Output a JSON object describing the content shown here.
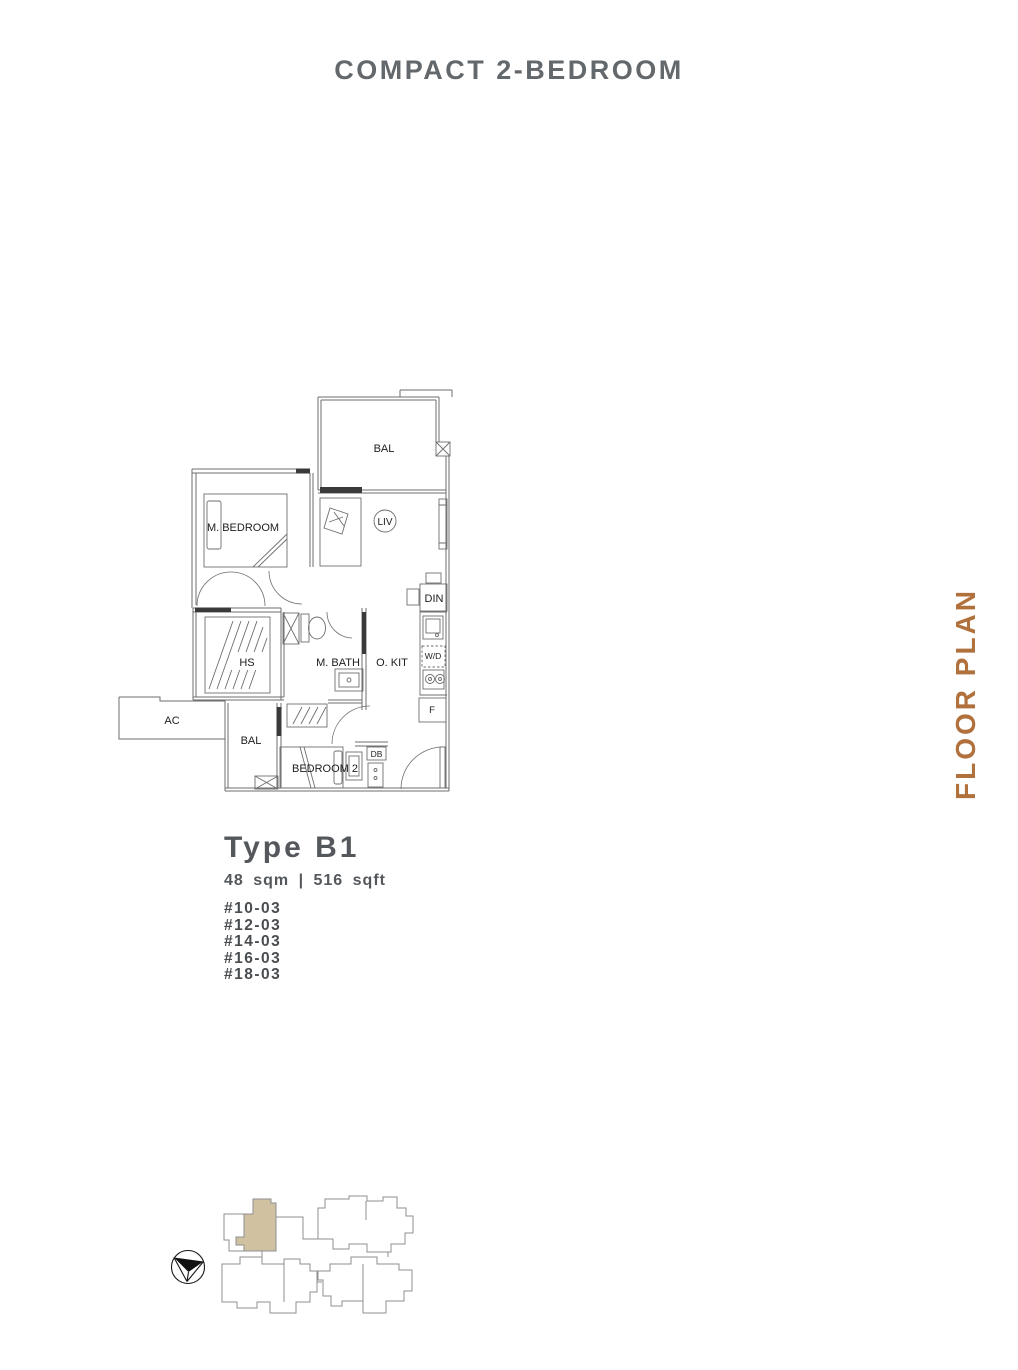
{
  "page": {
    "title": "COMPACT 2-BEDROOM"
  },
  "side_label": "FLOOR PLAN",
  "unit": {
    "type_label": "Type B1",
    "area": "48 sqm | 516 sqft",
    "units": [
      "#10-03",
      "#12-03",
      "#14-03",
      "#16-03",
      "#18-03"
    ]
  },
  "plan": {
    "labels": {
      "bal_top": "BAL",
      "m_bedroom": "M. BEDROOM",
      "liv": "LIV",
      "din": "DIN",
      "wd": "W/D",
      "fridge": "F",
      "hs": "HS",
      "m_bath": "M. BATH",
      "o_kit": "O. KIT",
      "ac": "AC",
      "bal_bottom": "BAL",
      "bedroom2": "BEDROOM 2",
      "db": "DB"
    }
  },
  "colors": {
    "accent": "#b1713c",
    "title": "#63686d",
    "body_text": "#54585c",
    "plan_line": "#6e6e6e",
    "plan_dark": "#3a3a3a",
    "plan_label": "#1d1d1d",
    "site_outline": "#8f8f8f",
    "site_highlight": "#d0c1a1"
  }
}
